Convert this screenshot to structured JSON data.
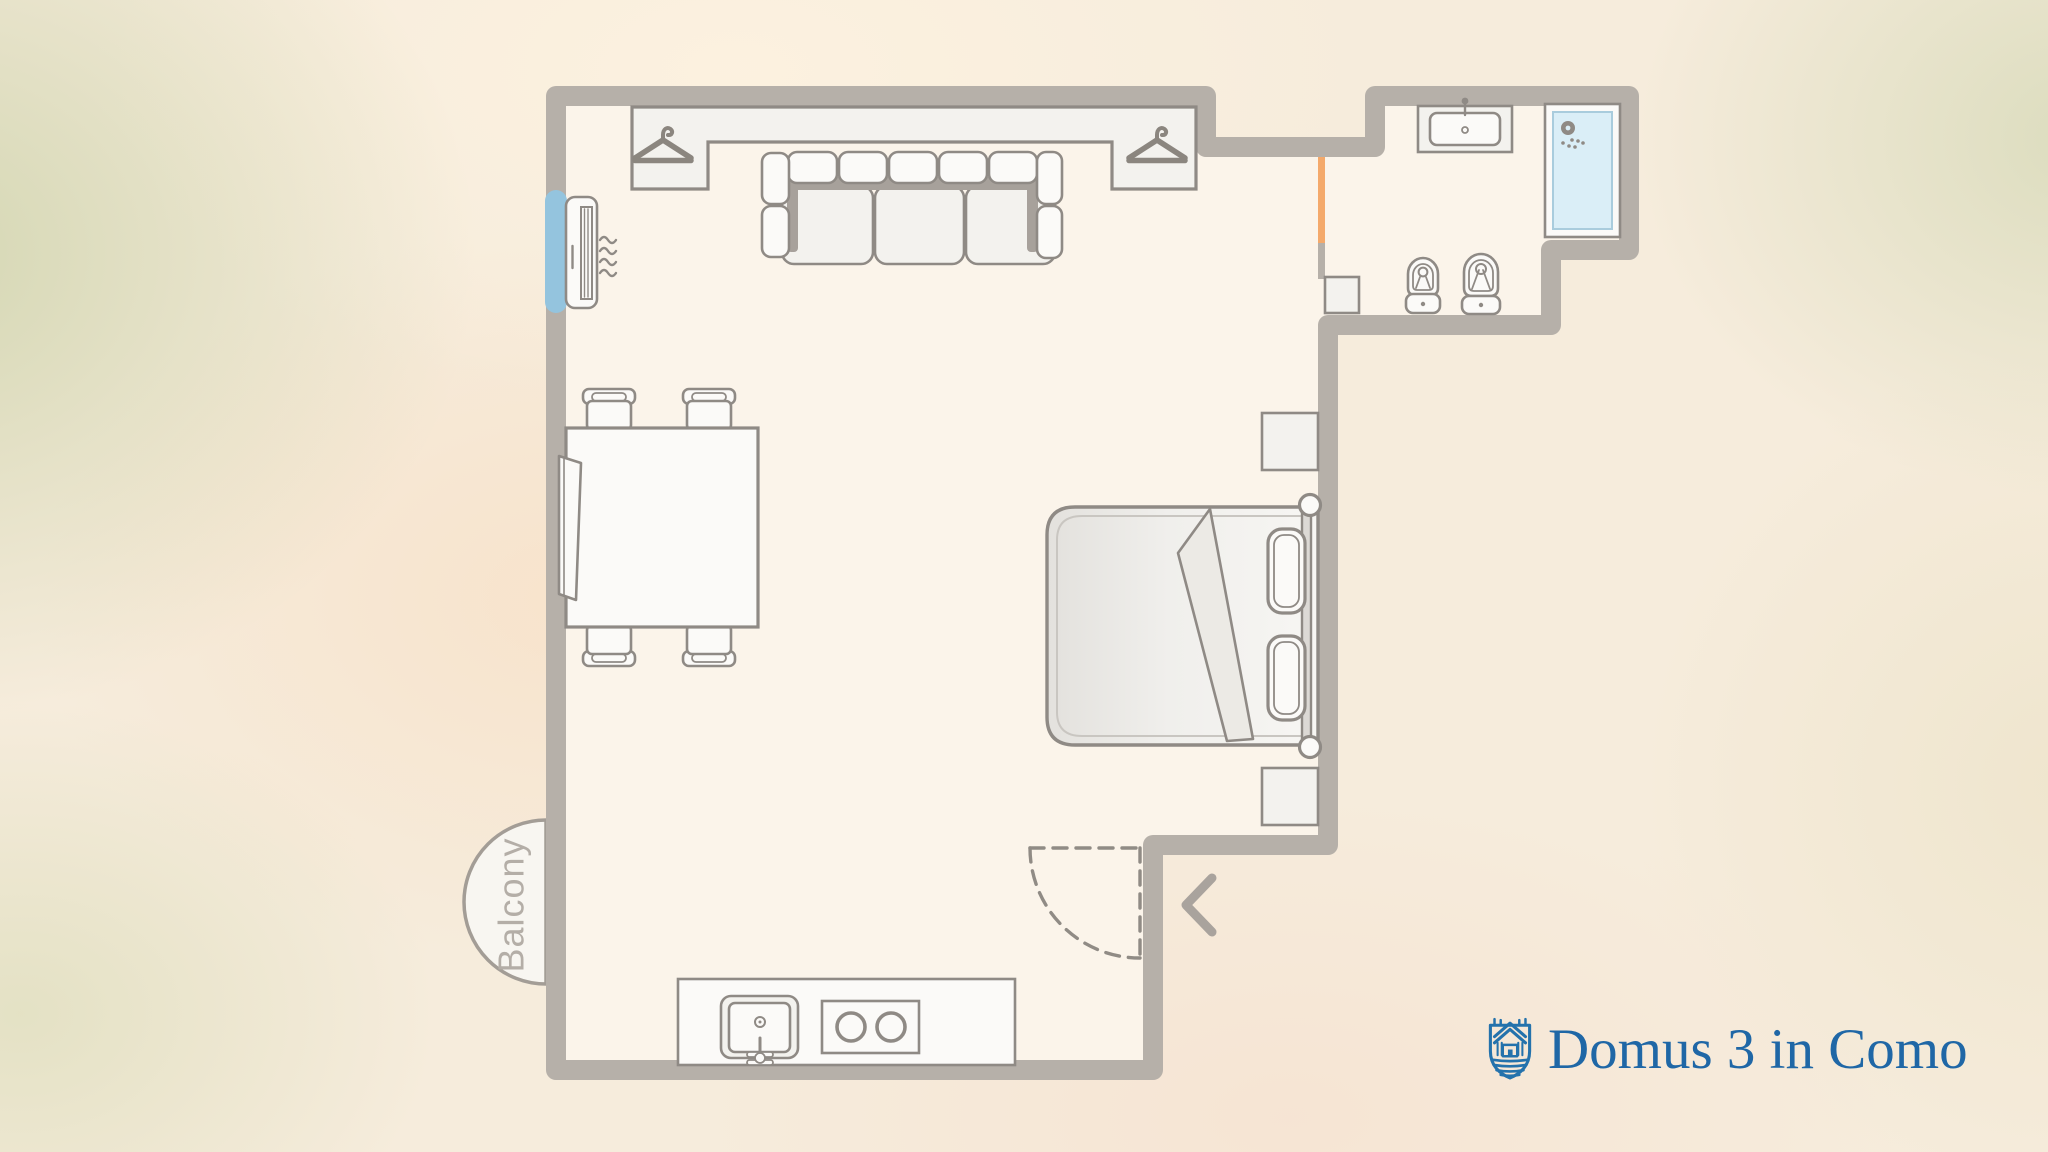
{
  "labels": {
    "balcony": "Balcony"
  },
  "branding": {
    "name": "Domus 3 in Como",
    "logo_icon": "shield-house-waves-icon",
    "text_color": "#1f67a6",
    "logo_color": "#2472ac"
  },
  "colors": {
    "wall": "#b6b0a9",
    "floor": "#fbf4ea",
    "furniture_outline": "#8f8a85",
    "furniture_fill": "#f3f2ee",
    "cushion_fill": "#fdfdfc",
    "shadow": "#a7a19b",
    "window_blue": "#94c4de",
    "shower_blue": "#daeef7",
    "door_orange": "#f4a96b",
    "balcony_text": "#b4aea7",
    "entry_arrow": "#a9a39d"
  },
  "fixtures": {
    "wardrobe_hangers": 2,
    "air_conditioner": true,
    "window_on_left_wall": true,
    "sofa_back_cushions": 5,
    "sofa_seat_cushions": 3,
    "dining_chairs": 4,
    "bed_pillows": 2,
    "nightstands": 2,
    "bathroom": [
      "vanity-sink",
      "shower",
      "bidet",
      "toilet",
      "cabinet"
    ],
    "kitchen": [
      "sink",
      "stove-2-burners"
    ],
    "entry": [
      "door-swing-dashed",
      "chevron-left-arrow"
    ],
    "bathroom_door_marker": "orange",
    "balcony_shape": "semicircle"
  }
}
